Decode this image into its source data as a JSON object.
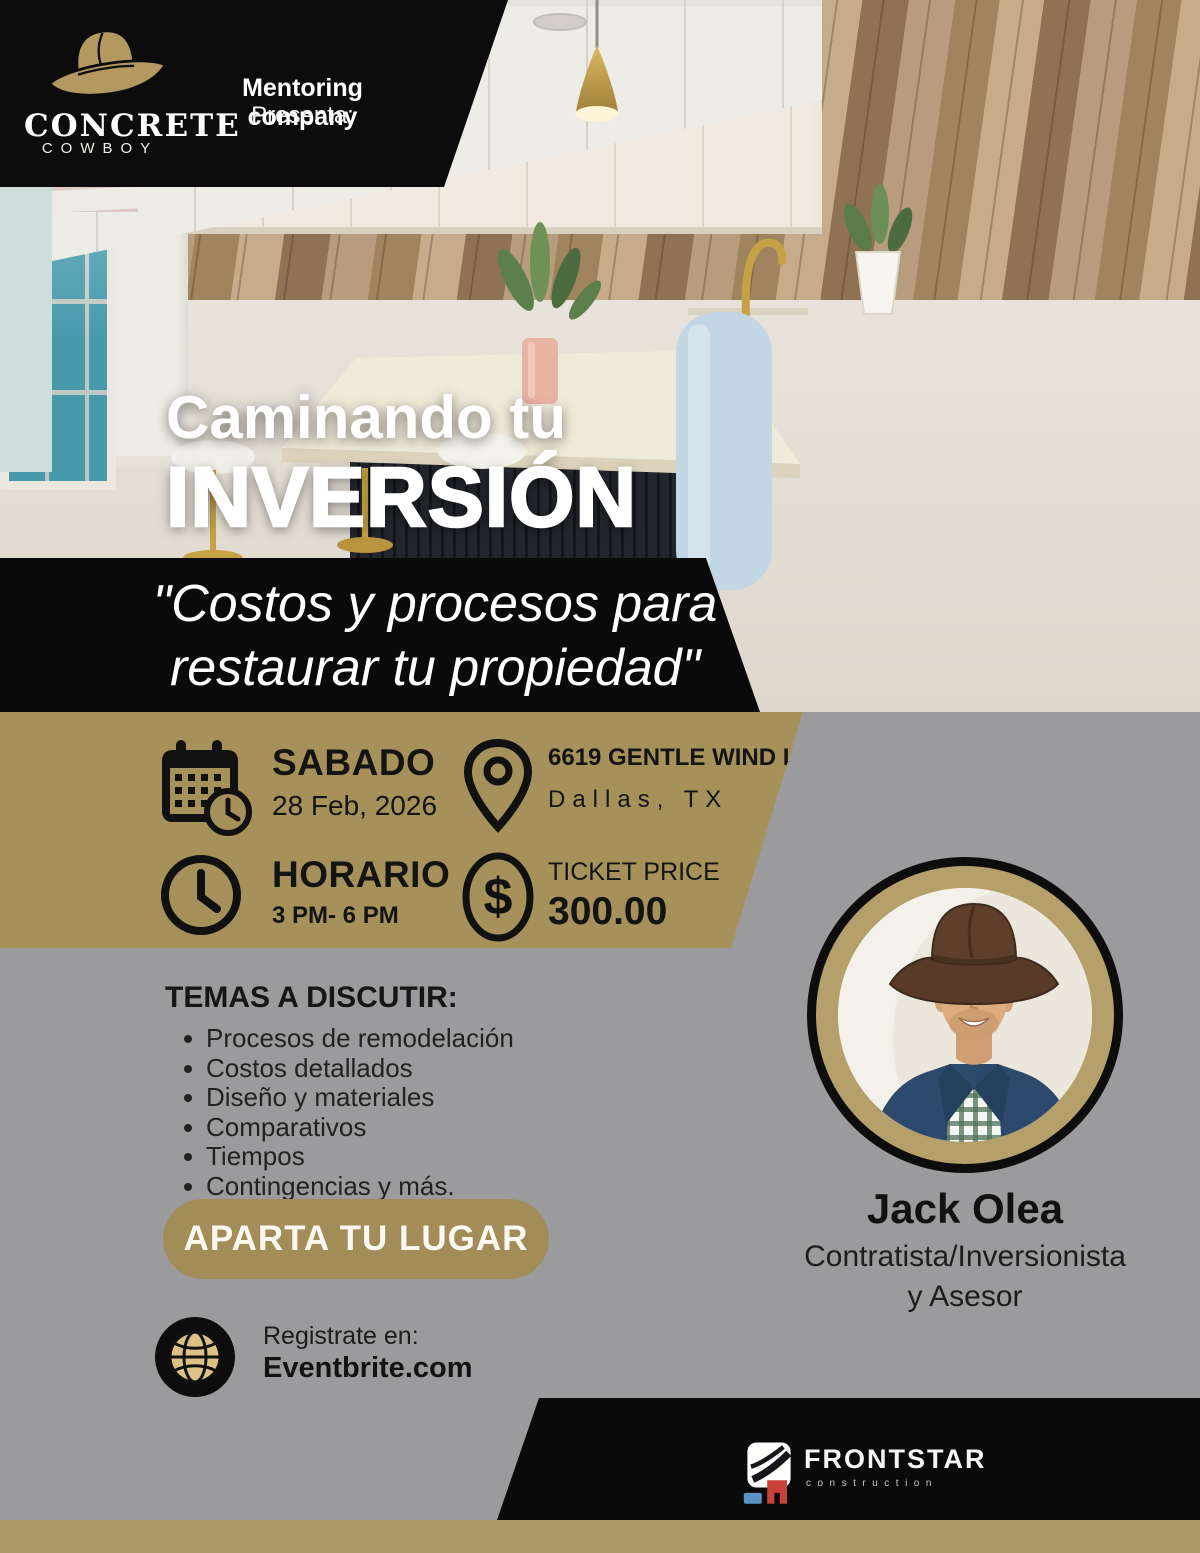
{
  "brand": {
    "logo_title": "CONCRETE",
    "logo_subtitle": "COWBOY",
    "presenter_line1": "Mentoring company",
    "presenter_line2": "Presenta:"
  },
  "hero": {
    "title_line1": "Caminando tu",
    "title_line2": "INVERSIÓN",
    "quote_line1": "\"Costos y procesos para",
    "quote_line2": "restaurar tu propiedad\""
  },
  "details": {
    "day_label": "SABADO",
    "date": "28 Feb, 2026",
    "address_line1": "6619 GENTLE WIND LN",
    "address_line2": "Dallas, TX",
    "schedule_label": "HORARIO",
    "schedule_time": "3 PM- 6 PM",
    "price_label": "TICKET PRICE",
    "price_value": "300.00"
  },
  "topics": {
    "heading": "TEMAS A DISCUTIR:",
    "items": [
      "Procesos de remodelación",
      "Costos detallados",
      "Diseño y materiales",
      "Comparativos",
      "Tiempos",
      "Contingencias y más."
    ]
  },
  "cta": {
    "button_label": "APARTA TU LUGAR",
    "register_label": "Registrate en:",
    "register_site": "Eventbrite.com"
  },
  "speaker": {
    "name": "Jack Olea",
    "role_line1": "Contratista/Inversionista",
    "role_line2": "y Asesor"
  },
  "footer": {
    "logo_text": "FRONTSTAR",
    "logo_subtext": "construction"
  },
  "icons": {
    "cowboy_hat": "cowboy-hat-icon",
    "calendar_clock": "calendar-clock-icon",
    "location_pin": "location-pin-icon",
    "clock": "clock-icon",
    "dollar": "dollar-icon",
    "globe": "globe-icon",
    "frontstar_mark": "frontstar-logo-icon"
  },
  "colors": {
    "gold_band": "#a6915b",
    "gold_button": "#a28d58",
    "gold_strip": "#ac9766",
    "background_gray": "#9b9b9d",
    "banner_black": "#0c0c0c",
    "text_dark": "#141414",
    "text_white": "#ffffff"
  }
}
